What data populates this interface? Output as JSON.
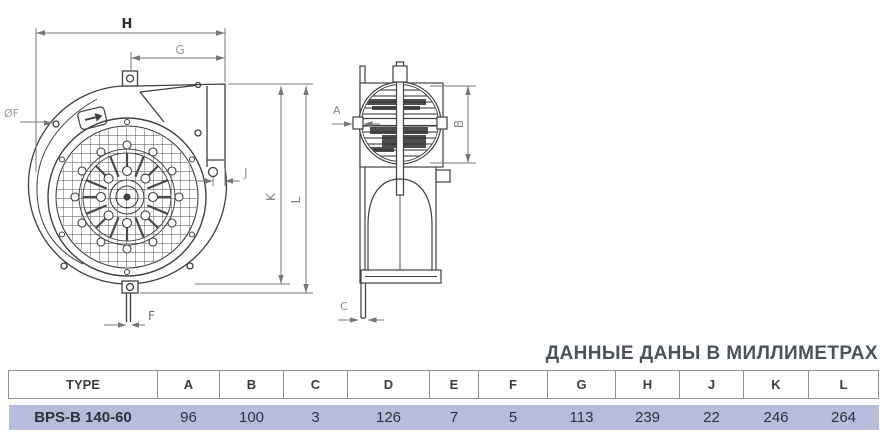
{
  "units_note": "ДАННЫЕ ДАНЫ В МИЛЛИМЕТРАХ",
  "front_view": {
    "labels": {
      "h": "H",
      "g": "G",
      "f_dia": "ØF",
      "j": "J",
      "k": "K",
      "l": "L",
      "f": "F"
    }
  },
  "side_view": {
    "labels": {
      "a": "A",
      "b": "B",
      "c": "C"
    }
  },
  "table": {
    "columns": [
      "TYPE",
      "A",
      "B",
      "C",
      "D",
      "E",
      "F",
      "G",
      "H",
      "J",
      "K",
      "L"
    ],
    "rows": [
      {
        "type": "BPS-B 140-60",
        "values": [
          "96",
          "100",
          "3",
          "126",
          "7",
          "5",
          "113",
          "239",
          "22",
          "246",
          "264"
        ]
      }
    ]
  },
  "colors": {
    "highlight_row": "#b7bcda",
    "title_text": "#4a525c",
    "drawing_line": "#3f3f3f",
    "dimension_line": "#777777",
    "table_border": "#8f8f8f"
  }
}
